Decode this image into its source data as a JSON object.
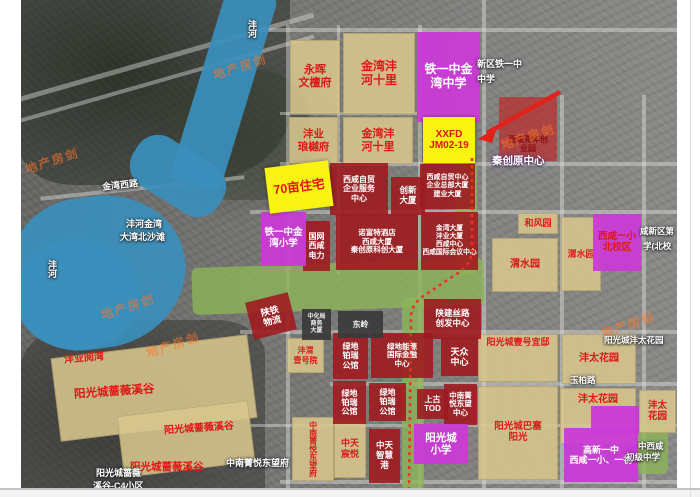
{
  "colors": {
    "water": "#3a8fbc",
    "park_green": "#8cb558",
    "plot_tan": "#d7c68d",
    "plot_red": "#9d1b1f",
    "school_magenta": "#ca3bd6",
    "highlight_yellow": "#f8f312",
    "label_red": "#df1717",
    "dotted_route_red": "#ea3323",
    "watermark_orange": "#ff7628"
  },
  "watermark": {
    "text": "地产房剑"
  },
  "plots": {
    "yonghui": "永晖\n文檀府",
    "jinwan_shili_1": "金湾沣\n河十里",
    "fengye_langyue": "沣业\n琅樾府",
    "jinwan_shili_2": "金湾沣\n河十里",
    "tieyi_zhongxue": "铁一中金\n湾中学",
    "xxfd": "XXFD\nJM02-19",
    "qingnian_chuangye": "西咸青年创\n业园",
    "qimu_zhuzhai": "70亩住宅",
    "zimao_fuwu": "西咸自贸\n企业服务\n中心",
    "chuangxin_daxia": "创新\n大厦",
    "zimao_zongbu": "西咸自贸中心\n企业总部大厦\n建业大厦",
    "tieyi_xiaoxue": "铁一中金\n湾小学",
    "guowang_dianli": "国网\n西咸\n电力",
    "nuofute": "诺富特酒店\n西咸大厦\n秦创原科创大厦",
    "jinwan_daxia": "金湾大厦\n沣业大厦\n西咸中心\n西咸国际会议中心",
    "hefengyuan": "和风园",
    "weishuiyuan_1": "渭水园",
    "weishuiyuan_2": "渭水园",
    "yixiao_beixiaoqu": "西咸一小\n北校区",
    "shantie_wuliu": "陕铁\n物流",
    "zhonghuaju": "中化局\n商务\n大厦",
    "dongling": "东岭",
    "ludi_bairui_1": "绿地\n铂瑞\n公馆",
    "ludi_nengyuan": "绿地能源\n国际金融\n中心",
    "shanjian_silu": "陕建丝路\n创发中心",
    "tianzhong": "天众\n中心",
    "fengwei_yihao": "沣渭\n壹号院",
    "ludi_bairui_2": "绿地\n铂瑞\n公馆",
    "ludi_bairui_3": "绿地\n铂瑞\n公馆",
    "shanggu_tod": "上古\nTOD",
    "zhongnan_center": "中南菁\n悦东望\n中心",
    "fengye_yuewan": "沣业阅湾",
    "qiangwei_xigu_1": "阳光城蔷薇溪谷",
    "qiangwei_xigu_2": "阳光城蔷薇溪谷",
    "qiangwei_xigu_3": "阳光城蔷薇溪谷",
    "zhongnan_fu": "中南菁悦东望府",
    "zhongtian_chenyue": "中天\n宸悦",
    "zhongtian_zhihui": "中天\n智慧\n港",
    "yangguang_xiaoxue": "阳光城\n小学",
    "yihao_yidi": "阳光城壹号宜邸",
    "basai_yangguang": "阳光城巴塞\n阳光",
    "fengtai_1": "沣太花园",
    "fengtai_2": "沣太花园",
    "fengtai_3": "沣太\n花园",
    "gaoxin_yizhong": "高新一中\n西咸一小、一初"
  },
  "map_texts": {
    "jinwanxilu": "金湾西路",
    "fenghe_jinwan": "沣河金湾",
    "beishatan": "大湾北沙滩",
    "fenghe_a": "沣河",
    "fenghe_b": "沣河",
    "xinqu_tieyi": "新区铁一中",
    "zhongxue": "中学",
    "qinchuangyuan": "秦创原中心",
    "xianxinqu_frag1": "咸新区第",
    "xianxinqu_frag2": "学(北校",
    "zhongnan_bg": "中南菁悦东望府",
    "c4_line1": "阳光城蔷薇",
    "c4_line2": "溪谷-C4小区",
    "fengtai_bg": "阳光城沣太花园",
    "zhongxixian_frag": "中西咸",
    "chuji_zhongxue": "初级中学",
    "yubolu": "玉柏路"
  }
}
